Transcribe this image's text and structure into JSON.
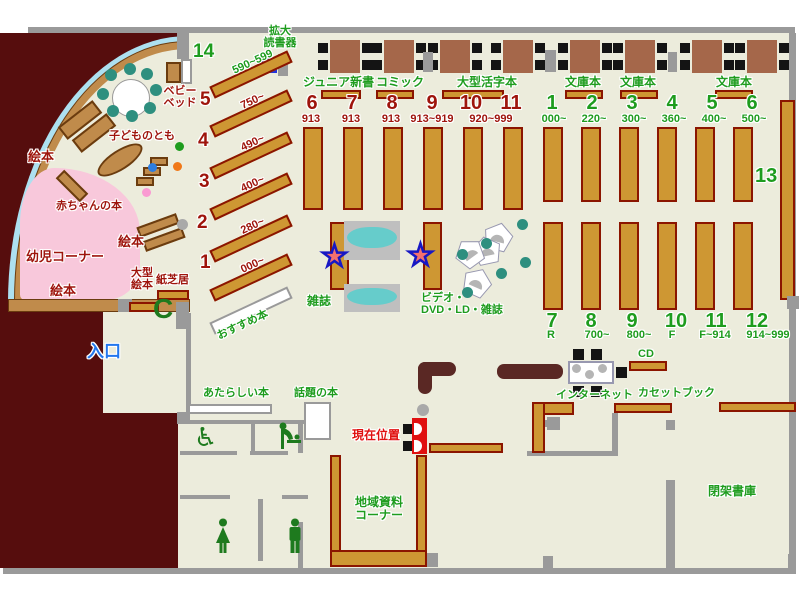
{
  "children_area": {
    "heading": "幼児コーナー",
    "picture_books": "絵本",
    "baby_books": "赤ちゃんの本",
    "kodomo_no_tomo": "子どものとも",
    "baby_bed_line1": "ベビー",
    "baby_bed_line2": "ベッド",
    "large_picture_line1": "大型",
    "large_picture_line2": "絵本",
    "kamishibai": "紙芝居",
    "c_seat": "C"
  },
  "junior": {
    "magnifier_line1": "拡大",
    "magnifier_line2": "読書器",
    "diagonal_shelves": [
      {
        "no": "14",
        "range": "590~599"
      },
      {
        "no": "5",
        "range": "750~"
      },
      {
        "no": "4",
        "range": "490~"
      },
      {
        "no": "3",
        "range": "400~"
      },
      {
        "no": "2",
        "range": "280~"
      },
      {
        "no": "1",
        "range": "000~"
      }
    ],
    "recommended": "おすすめ本",
    "sections": [
      "ジュニア新書",
      "コミック",
      "大型活字本"
    ],
    "class_shelves": [
      {
        "no": "6",
        "range": "913"
      },
      {
        "no": "7",
        "range": "913"
      },
      {
        "no": "8",
        "range": "913"
      },
      {
        "no": "9",
        "range": "913~919"
      },
      {
        "no": "10",
        "range": "920~999"
      },
      {
        "no": "11",
        "range": ""
      }
    ]
  },
  "adult": {
    "bunko": "文庫本",
    "top_shelves": [
      {
        "no": "1",
        "range": "000~"
      },
      {
        "no": "2",
        "range": "220~"
      },
      {
        "no": "3",
        "range": "300~"
      },
      {
        "no": "4",
        "range": "360~"
      },
      {
        "no": "5",
        "range": "400~"
      },
      {
        "no": "6",
        "range": "500~"
      }
    ],
    "bottom_shelves": [
      {
        "no": "7",
        "range": "R"
      },
      {
        "no": "8",
        "range": "700~"
      },
      {
        "no": "9",
        "range": "800~"
      },
      {
        "no": "10",
        "range": "F"
      },
      {
        "no": "11",
        "range": "F~914"
      },
      {
        "no": "12",
        "range": "914~999"
      }
    ],
    "wall_shelf_no": "13"
  },
  "center": {
    "magazines": "雑誌",
    "av_line1": "ビデオ・",
    "av_line2": "DVD・LD・雑誌"
  },
  "services": {
    "current_location": "現在位置",
    "internet": "インターネット",
    "cd": "CD",
    "cassette_books": "カセットブック",
    "closed_stacks": "閉架書庫",
    "local_line1": "地域資料",
    "local_line2": "コーナー",
    "new_books": "あたらしい本",
    "topic_books": "話題の本",
    "entrance": "入口"
  },
  "colors": {
    "floor": "#ECECDC",
    "exterior": "#560D0D",
    "shelf": "#CE9733",
    "shelf_border": "#8B1500",
    "children_wood": "#C08B4B",
    "wall": "#9A9A9A",
    "label_green": "#1E9C1E",
    "label_dark_red": "#9E140C",
    "entrance_blue": "#2277EE",
    "current_red": "#E01010",
    "kids_pink": "#F8C8DB",
    "rack_cyan": "#66CCCB",
    "chair_teal": "#2E8F7F",
    "counter_maroon": "#5A2824",
    "star_red": "#F4706E",
    "star_blue": "#1717C4",
    "magnifier_blue": "#2233DD"
  }
}
